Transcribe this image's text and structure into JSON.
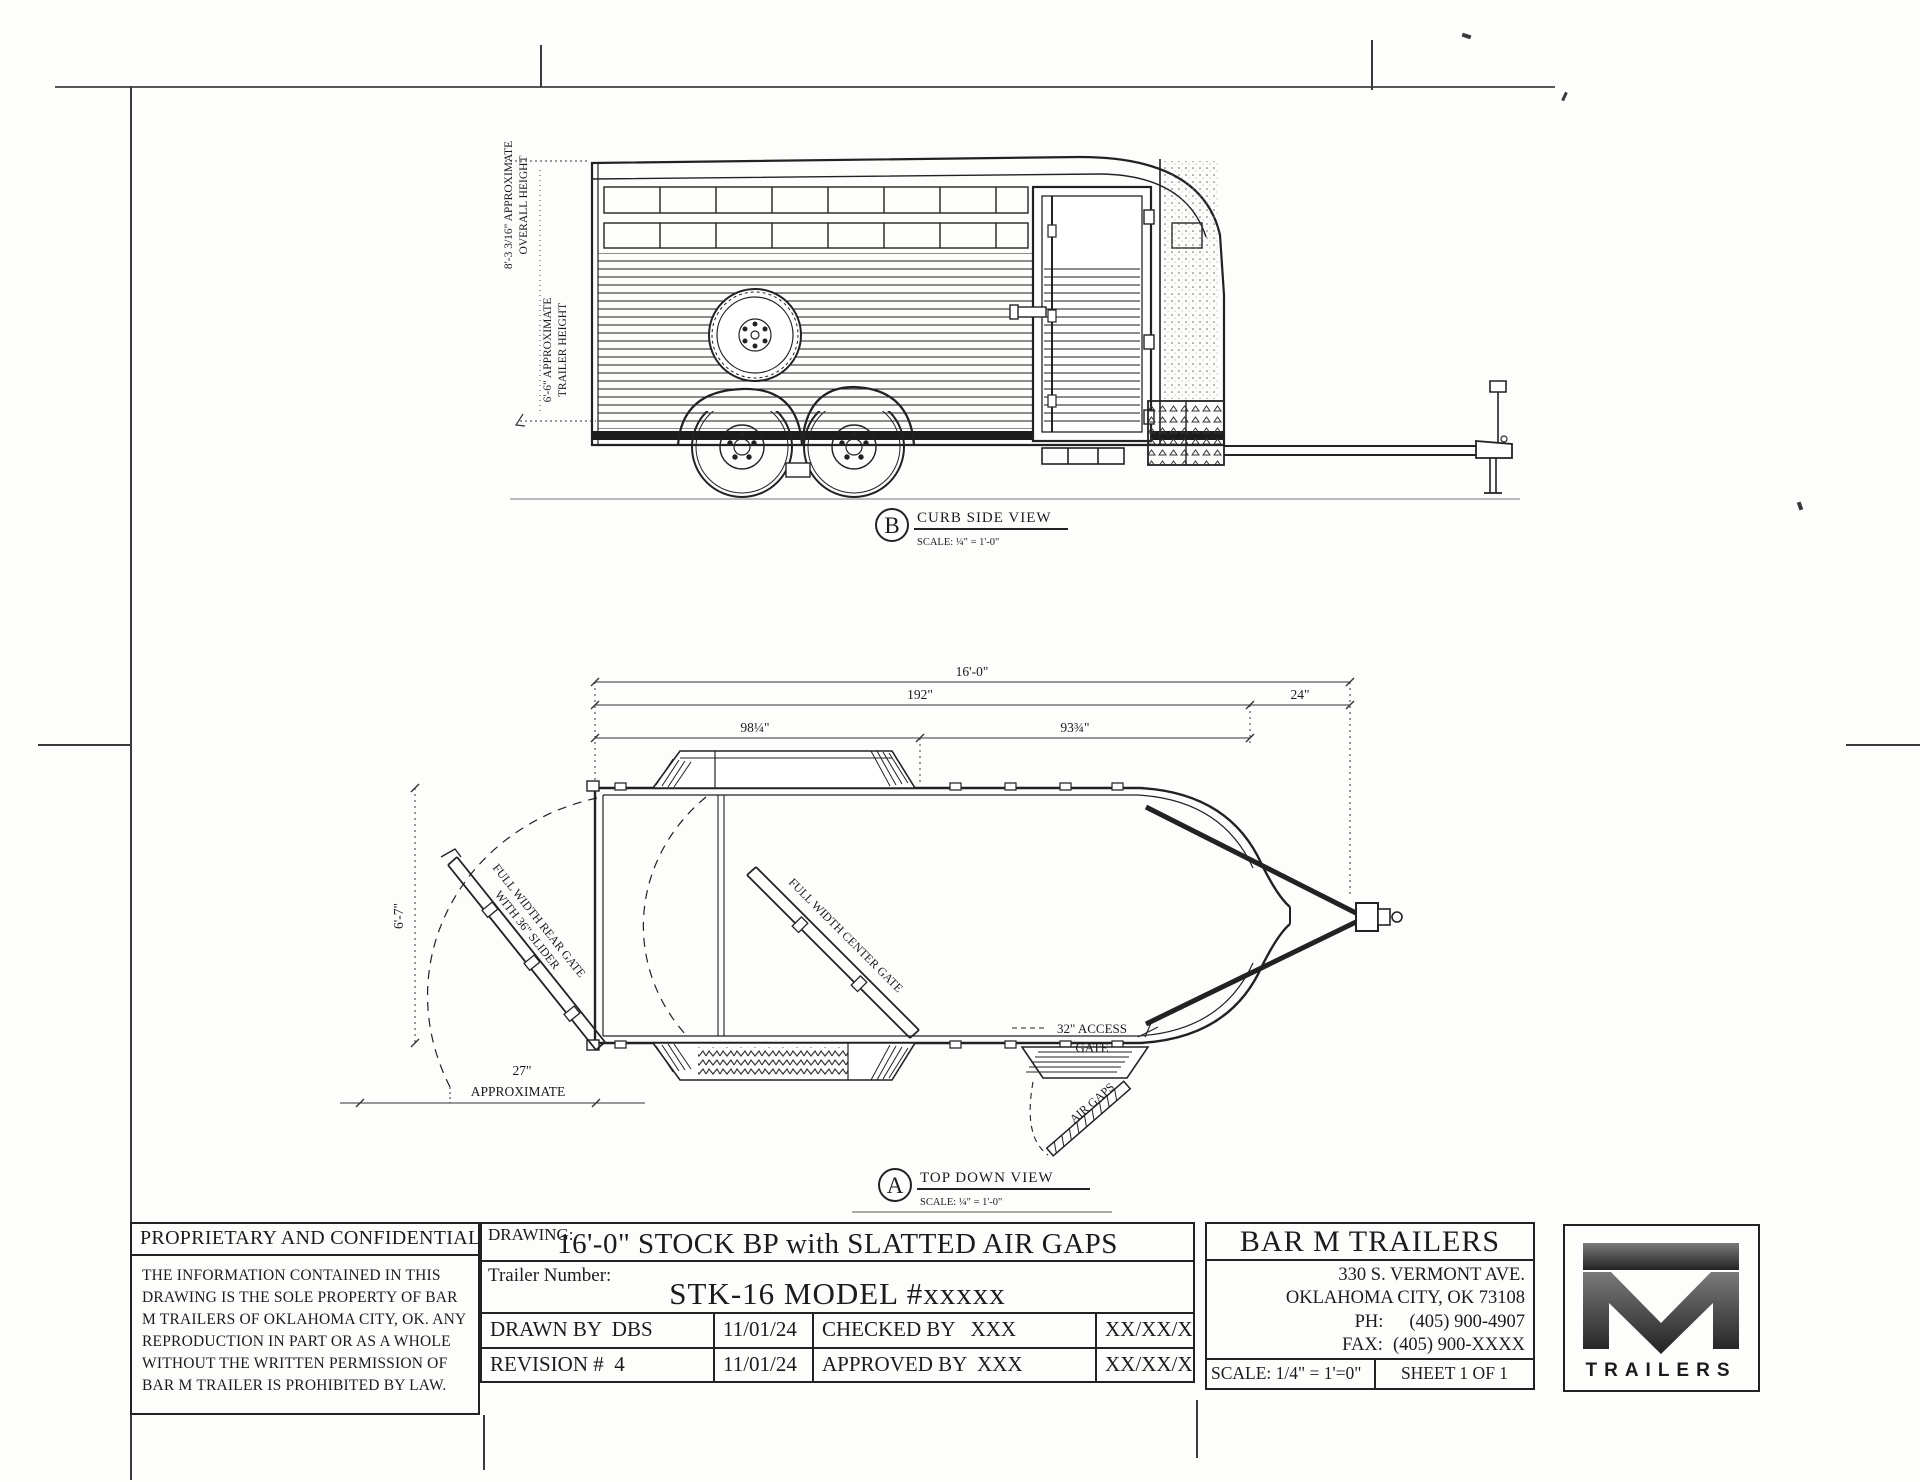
{
  "side_view": {
    "dim_overall_line1": "8'-3 3/16\" APPROXIMATE",
    "dim_overall_line2": "OVERALL HEIGHT",
    "dim_height_line1": "6'-6\" APPROXIMATE",
    "dim_height_line2": "TRAILER HEIGHT",
    "callout_letter": "B",
    "callout_title": "CURB SIDE VIEW",
    "callout_scale": "SCALE: ¼\" = 1'-0\""
  },
  "top_view": {
    "dim_overall": "16'-0\"",
    "dim_body": "192\"",
    "dim_tongue": "24\"",
    "dim_rear_section": "98¼\"",
    "dim_front_section": "93¾\"",
    "dim_width": "6'-7\"",
    "dim_swing_line1": "27\"",
    "dim_swing_line2": "APPROXIMATE",
    "label_rear_gate_line1": "FULL WIDTH REAR GATE",
    "label_rear_gate_line2": "WITH 36\" SLIDER",
    "label_center_gate": "FULL WIDTH CENTER GATE",
    "label_access_line1": "32\" ACCESS",
    "label_access_line2": "GATE",
    "label_air_gaps": "AIR GAPS",
    "callout_letter": "A",
    "callout_title": "TOP DOWN VIEW",
    "callout_scale": "SCALE: ¼\" = 1'-0\""
  },
  "title_block": {
    "proprietary_heading": "PROPRIETARY AND CONFIDENTIAL",
    "proprietary_body": "THE INFORMATION CONTAINED IN THIS DRAWING IS THE SOLE PROPERTY OF BAR M TRAILERS OF OKLAHOMA CITY, OK. ANY REPRODUCTION IN PART OR AS A WHOLE WITHOUT THE WRITTEN PERMISSION OF BAR M TRAILER IS PROHIBITED BY LAW.",
    "drawing_label": "DRAWING:",
    "drawing_title": "16'-0\" STOCK BP with SLATTED AIR GAPS",
    "trailer_number_label": "Trailer Number:",
    "trailer_number": "STK-16 MODEL #xxxxx",
    "rows": [
      [
        "DRAWN BY  DBS",
        "11/01/24",
        "CHECKED BY   XXX",
        "XX/XX/XX"
      ],
      [
        "REVISION #  4",
        "11/01/24",
        "APPROVED BY  XXX",
        "XX/XX/XX"
      ]
    ],
    "company_name": "BAR M TRAILERS",
    "address_line1": "330 S. VERMONT AVE.",
    "address_line2": "OKLAHOMA CITY, OK 73108",
    "phone_label": "PH:",
    "phone_value": "(405) 900-4907",
    "fax_label": "FAX:",
    "fax_value": "(405) 900-XXXX",
    "scale": "SCALE: 1/4\" = 1'=0\"",
    "sheet": "SHEET 1 OF 1",
    "logo_text": "TRAILERS"
  }
}
